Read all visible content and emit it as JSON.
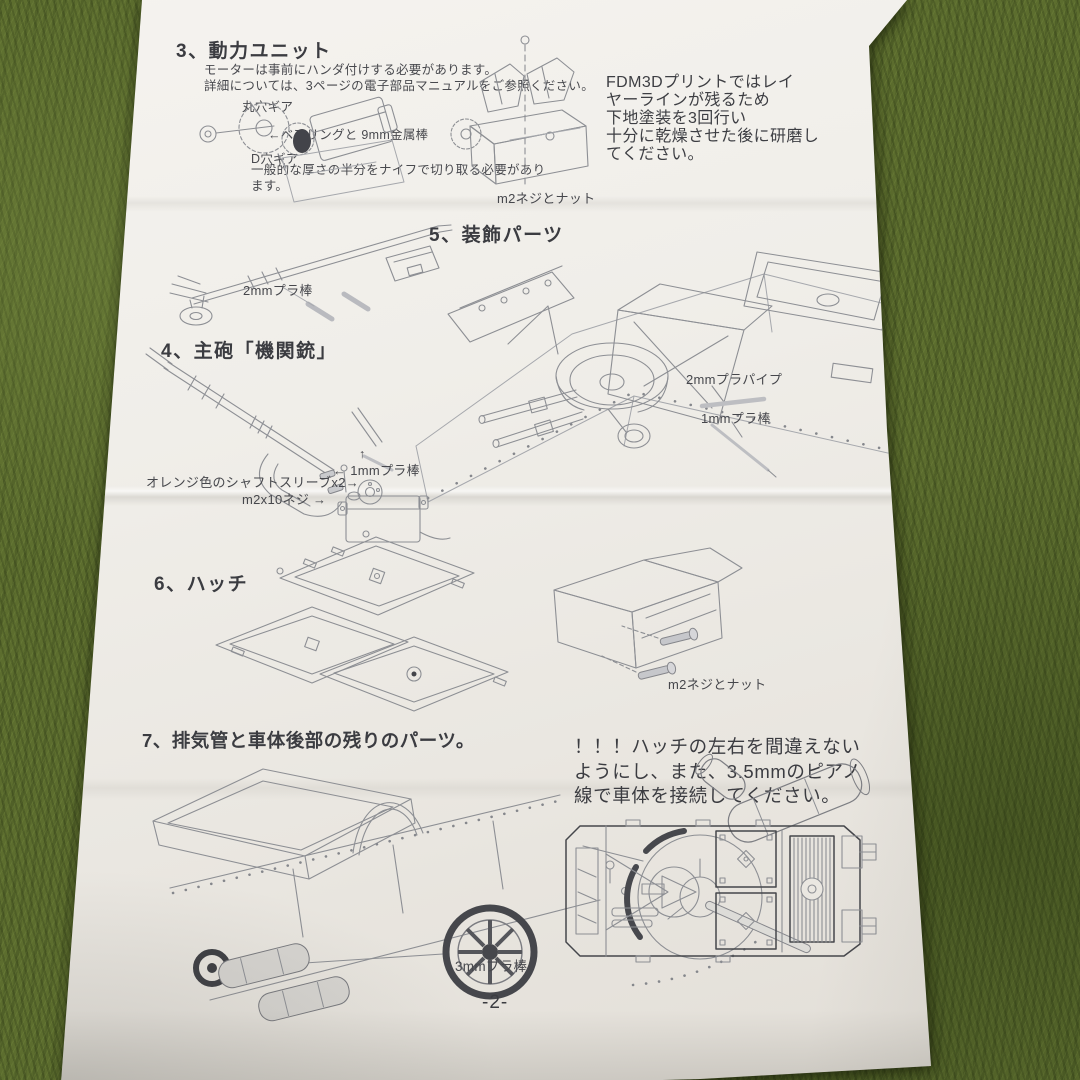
{
  "colors": {
    "carpet_green": "#5c6d2e",
    "paper_white": "#efede8",
    "ink_dark": "#3e3f44",
    "line_art_gray": "#8d8f94"
  },
  "page": {
    "number_label": "-2-"
  },
  "notes": {
    "finish_note": "FDM3Dプリントではレイ\nヤーラインが残るため\n下地塗装を3回行い\n十分に乾燥させた後に研磨し\nてください。",
    "hatch_warning": "！！！ハッチの左右を間違えない\nようにし、また、3.5mmのピアノ\n線で車体を接続してください。"
  },
  "sections": {
    "power_unit": {
      "title": "3、動力ユニット",
      "note_line1": "モーターは事前にハンダ付けする必要があります。",
      "note_line2": "詳細については、3ページの電子部品マニュアルをご参照ください。",
      "label_round_hole_gear": "丸穴ギア",
      "label_bearing_rod": "←ベアリングと 9mm金属棒",
      "label_d_hole_gear": "D穴ギア",
      "label_cut_note": "一般的な厚さの半分をナイフで切り取る必要があります。",
      "label_screw_nut": "m2ネジとナット"
    },
    "main_gun": {
      "title": "4、主砲「機関銃」",
      "label_rod_2mm": "2mmプラ棒",
      "label_arrow_up": "↑",
      "label_rod_1mm": "← 1mmプラ棒",
      "label_shaft_sleeve": "オレンジ色のシャフトスリーブx2→",
      "label_screw_m2x10": "m2x10ネジ →"
    },
    "decoration": {
      "title": "5、装飾パーツ",
      "label_pipe_2mm": "2mmプラパイプ",
      "label_rod_1mm": "1mmプラ棒"
    },
    "hatch": {
      "title": "6、ハッチ",
      "label_screw_nut": "m2ネジとナット"
    },
    "rear": {
      "title": "7、排気管と車体後部の残りのパーツ。",
      "label_rod_3mm": "3mmプラ棒"
    }
  }
}
